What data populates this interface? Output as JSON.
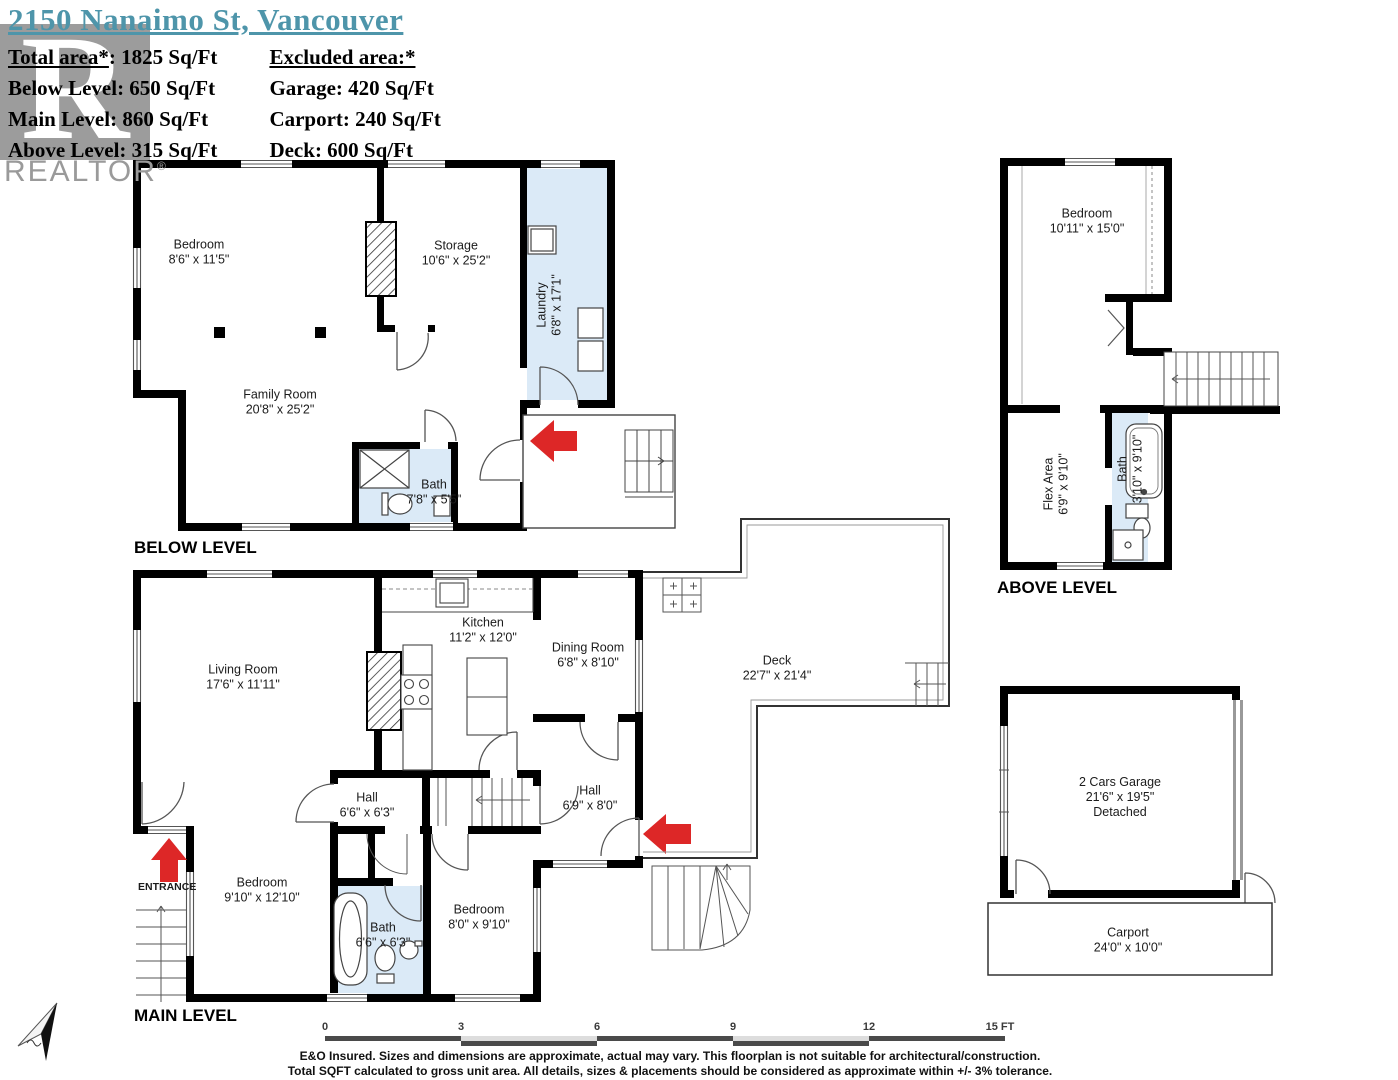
{
  "header": {
    "title": "2150 Nanaimo St, Vancouver",
    "included": [
      {
        "label": "Total area*",
        "value": ": 1825 Sq/Ft"
      },
      {
        "label": "Below Level",
        "value": ": 650 Sq/Ft"
      },
      {
        "label": "Main Level",
        "value": ": 860 Sq/Ft"
      },
      {
        "label": "Above Level",
        "value": ": 315 Sq/Ft"
      }
    ],
    "excluded_heading": "Excluded area:*",
    "excluded": [
      {
        "label": "Garage",
        "value": ": 420 Sq/Ft"
      },
      {
        "label": "Carport",
        "value": ": 240 Sq/Ft"
      },
      {
        "label": "Deck",
        "value": ": 600 Sq/Ft"
      }
    ]
  },
  "watermark": {
    "letter": "R",
    "text": "REALTOR",
    "reg": "®"
  },
  "plans": {
    "below": {
      "title": "BELOW LEVEL",
      "rooms": [
        {
          "name": "Bedroom",
          "dims": "8'6\" x 11'5\""
        },
        {
          "name": "Storage",
          "dims": "10'6\" x 25'2\""
        },
        {
          "name": "Laundry",
          "dims": "6'8\" x 17'1\""
        },
        {
          "name": "Family Room",
          "dims": "20'8\" x 25'2\""
        },
        {
          "name": "Bath",
          "dims": "7'8\" x 5'5\""
        }
      ]
    },
    "main": {
      "title": "MAIN LEVEL",
      "entrance_label": "ENTRANCE",
      "rooms": [
        {
          "name": "Living Room",
          "dims": "17'6\" x 11'11\""
        },
        {
          "name": "Kitchen",
          "dims": "11'2\" x 12'0\""
        },
        {
          "name": "Dining Room",
          "dims": "6'8\" x 8'10\""
        },
        {
          "name": "Deck",
          "dims": "22'7\" x 21'4\""
        },
        {
          "name": "Hall",
          "dims": "6'6\" x 6'3\""
        },
        {
          "name": "Hall",
          "dims": "6'9\" x 8'0\""
        },
        {
          "name": "Bedroom",
          "dims": "9'10\" x 12'10\""
        },
        {
          "name": "Bath",
          "dims": "6'6\" x 6'3\""
        },
        {
          "name": "Bedroom",
          "dims": "8'0\" x 9'10\""
        }
      ]
    },
    "above": {
      "title": "ABOVE LEVEL",
      "rooms": [
        {
          "name": "Bedroom",
          "dims": "10'11\" x 15'0\""
        },
        {
          "name": "Flex Area",
          "dims": "6'9\" x 9'10\""
        },
        {
          "name": "Bath",
          "dims": "3'10\" x 9'10\""
        }
      ]
    },
    "garage": {
      "rooms": [
        {
          "name": "2 Cars Garage",
          "dims": "21'6\" x 19'5\"",
          "extra": "Detached"
        },
        {
          "name": "Carport",
          "dims": "24'0\" x 10'0\""
        }
      ]
    }
  },
  "scale_bar": {
    "ticks": [
      "0",
      "3",
      "6",
      "9",
      "12",
      "15 FT"
    ]
  },
  "disclaimer": {
    "line1": "E&O Insured. Sizes and dimensions are approximate, actual may vary. This floorplan is not suitable for architectural/construction.",
    "line2": "Total SQFT calculated to gross unit area. All details, sizes & placements should be considered as approximate within +/- 3% tolerance."
  },
  "compass": {
    "label": "N"
  },
  "colors": {
    "title_accent": "#4e95aa",
    "wet_room_fill": "#dbeaf7",
    "arrow_red": "#dd2727",
    "wall_black": "#000000",
    "watermark_gray": "#8f8f8f"
  }
}
